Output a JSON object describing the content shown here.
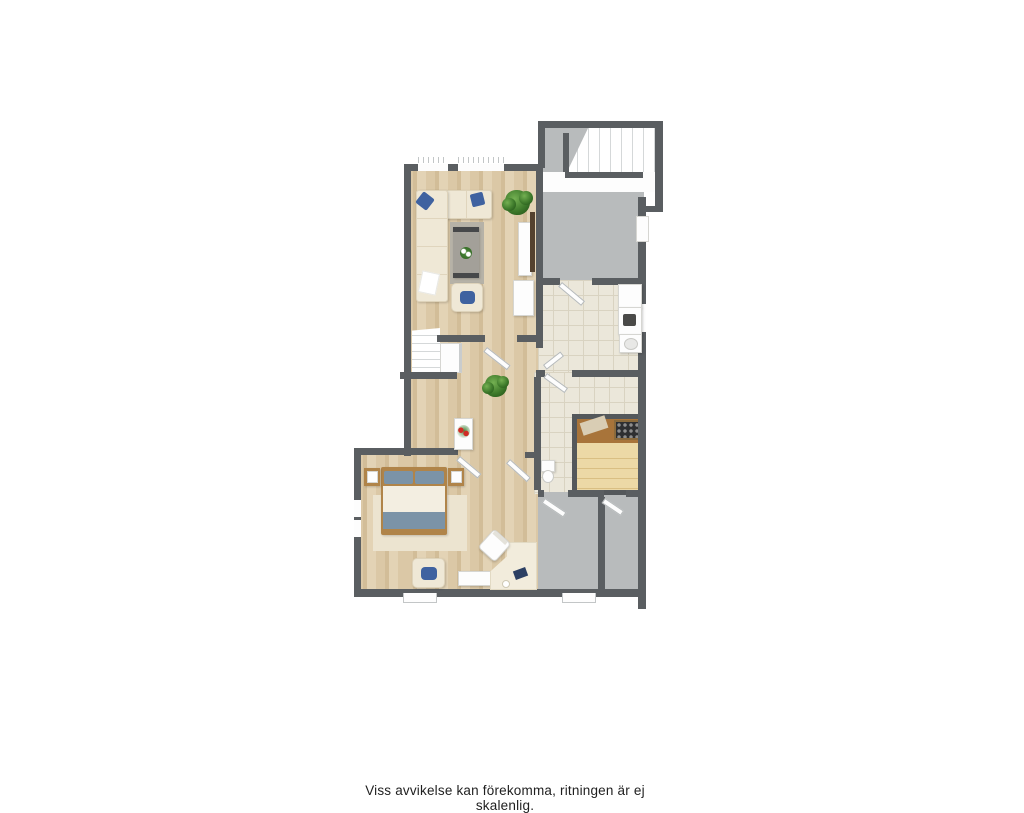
{
  "caption": "Viss avvikelse kan förekomma, ritningen är ej skalenlig.",
  "colors": {
    "wall": "#5a5e61",
    "wood_floor": "#dbc8a6",
    "wood_floor_dark": "#d2bd98",
    "wood_floor_light": "#e3d3b5",
    "gray_floor": "#b8bbbc",
    "tile": "#ebe7da",
    "tile_grout": "#d9d3c1",
    "rug": "#b6b2a7",
    "sofa": "#efe8d6",
    "accent_blue": "#3f62a0",
    "bed_textile": "#7b93a7",
    "bed_wood": "#b08449",
    "sauna_bench": "#ecd9a6",
    "sauna_wood": "#a8743a",
    "plant_green": "#3e7a2b",
    "flower_red": "#cf2b25",
    "white": "#fdfdfd",
    "caption_text": "#1f1f1f",
    "page_bg": "#ffffff"
  }
}
